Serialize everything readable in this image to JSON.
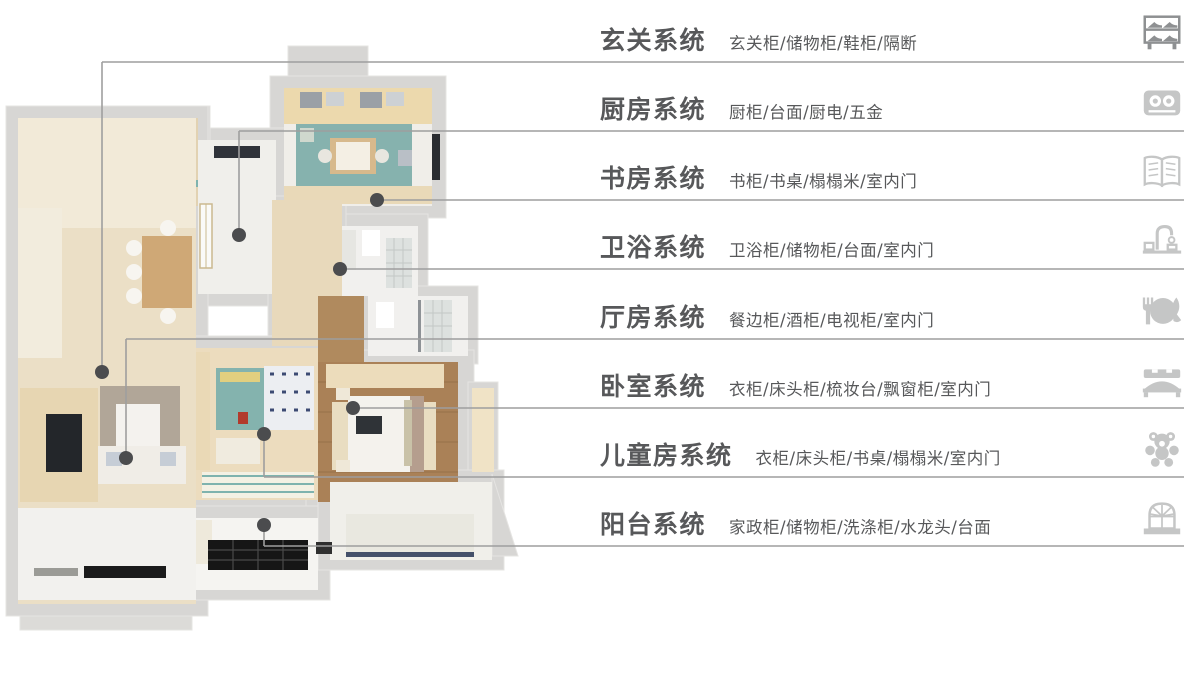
{
  "page": {
    "kind": "home-customization systems infographic",
    "background": "#ffffff"
  },
  "theme": {
    "text_color": "#57585a",
    "line_color": "#9e9e9e",
    "dot_color": "#4b4c4e",
    "icon_color": "#c5c6c6",
    "icon_color_dark": "#8e9092"
  },
  "floor_plan": {
    "type": "3d-rendered top-down apartment floor plan",
    "palette": {
      "outer_wall": "#d7d6d4",
      "wood_floor": "#ebdfc6",
      "dark_wood_floor": "#aa8157",
      "teal_rug": "#86b2ae",
      "tile": "#f1f0ee",
      "black_mat": "#1b1b1b"
    }
  },
  "legend": {
    "rows": [
      {
        "title": "玄关系统",
        "items": "玄关柜/储物柜/鞋柜/隔断",
        "icon": "shoe-rack"
      },
      {
        "title": "厨房系统",
        "items": "厨柜/台面/厨电/五金",
        "icon": "stove"
      },
      {
        "title": "书房系统",
        "items": "书柜/书桌/榻榻米/室内门",
        "icon": "open-book"
      },
      {
        "title": "卫浴系统",
        "items": "卫浴柜/储物柜/台面/室内门",
        "icon": "faucet"
      },
      {
        "title": "厅房系统",
        "items": "餐边柜/酒柜/电视柜/室内门",
        "icon": "dining-plate"
      },
      {
        "title": "卧室系统",
        "items": "衣柜/床头柜/梳妆台/飘窗柜/室内门",
        "icon": "bed"
      },
      {
        "title": "儿童房系统",
        "items": "衣柜/床头柜/书桌/榻榻米/室内门",
        "icon": "teddy-bear"
      },
      {
        "title": "阳台系统",
        "items": "家政柜/储物柜/洗涤柜/水龙头/台面",
        "icon": "window"
      }
    ]
  }
}
